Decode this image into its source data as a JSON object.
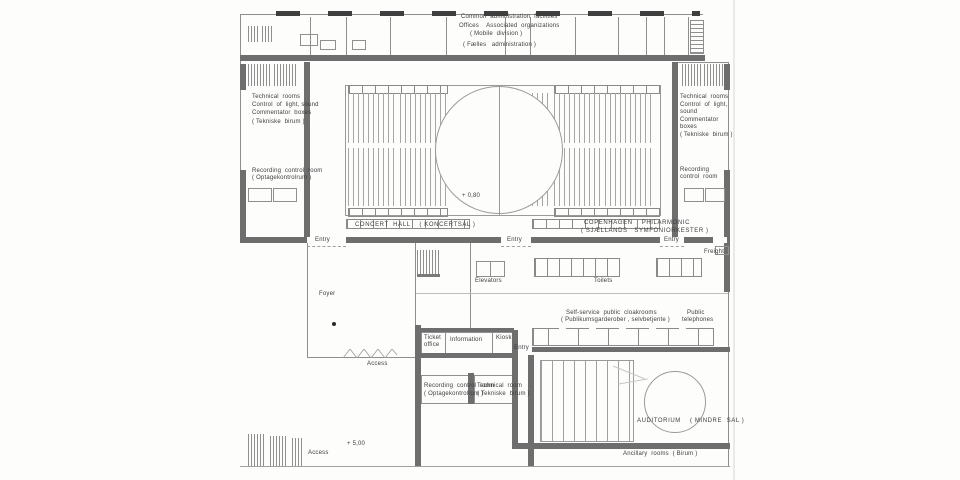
{
  "meta": {
    "drawing_type": "concert hall floor plan (scanned architectural drawing)"
  },
  "colors": {
    "paper": "#fdfdfc",
    "thin_line": "#8f8f8f",
    "thick_wall": "#6e6e6e",
    "hatch": "#a6a6a6",
    "text": "#3d3d3d",
    "window_band": "#3f3f3f"
  },
  "levels": {
    "hall_level": "+ 0,80",
    "plaza_level": "+ 5,00"
  },
  "rooms": {
    "concert_hall": "CONCERT  HALL    ( KONCERTSAL )",
    "orchestra": "COPENHAGEN    PHILARMONIC  ( SJÆLLANDS   SYMFONIORKESTER )",
    "auditorium": "AUDITORIUM    ( MINDRE  SAL )",
    "administration": "Common  administration  facilities",
    "foyer": "Foyer"
  },
  "labels": [
    {
      "id": "admin-1",
      "text": "Common  administration  facilities",
      "x": 461,
      "y": 14
    },
    {
      "id": "admin-2",
      "text": "Offices    Associated  organizations",
      "x": 459,
      "y": 23
    },
    {
      "id": "admin-3",
      "text": "( Mobile  division )",
      "x": 470,
      "y": 31
    },
    {
      "id": "admin-4",
      "text": "( Fælles   administration )",
      "x": 463,
      "y": 42
    },
    {
      "id": "left-tech-1",
      "text": "Technical  rooms",
      "x": 252,
      "y": 94
    },
    {
      "id": "left-tech-2",
      "text": "Control  of  light, sound",
      "x": 252,
      "y": 102
    },
    {
      "id": "left-tech-3",
      "text": "Commentator  boxes",
      "x": 252,
      "y": 110
    },
    {
      "id": "left-tech-4",
      "text": "( Tekniske  birum )",
      "x": 252,
      "y": 119
    },
    {
      "id": "left-rec-1",
      "text": "Recording  control  room",
      "x": 252,
      "y": 168
    },
    {
      "id": "left-rec-2",
      "text": "( Optagekontrolrum )",
      "x": 252,
      "y": 175
    },
    {
      "id": "right-tech-1",
      "text": "Technical  rooms",
      "x": 680,
      "y": 94
    },
    {
      "id": "right-tech-2",
      "text": "Control  of  light,",
      "x": 680,
      "y": 102
    },
    {
      "id": "right-tech-3",
      "text": "sound",
      "x": 680,
      "y": 109
    },
    {
      "id": "right-tech-4",
      "text": "Commentator",
      "x": 680,
      "y": 117
    },
    {
      "id": "right-tech-5",
      "text": "boxes",
      "x": 680,
      "y": 124
    },
    {
      "id": "right-tech-6",
      "text": "( Tekniske  birum )",
      "x": 680,
      "y": 132
    },
    {
      "id": "right-rec-1",
      "text": "Recording",
      "x": 680,
      "y": 167
    },
    {
      "id": "right-rec-2",
      "text": "control  room",
      "x": 680,
      "y": 174
    },
    {
      "id": "hall-level",
      "text": "+ 0,80",
      "x": 462,
      "y": 193
    },
    {
      "id": "hall-name",
      "text": "CONCERT  HALL    ( KONCERTSAL )",
      "x": 355,
      "y": 222,
      "caps": true
    },
    {
      "id": "orch-1",
      "text": "COPENHAGEN    PHILARMONIC",
      "x": 584,
      "y": 220,
      "caps": true
    },
    {
      "id": "orch-2",
      "text": "( SJÆLLANDS   SYMFONIORKESTER )",
      "x": 581,
      "y": 228,
      "caps": true
    },
    {
      "id": "entry-left",
      "text": "Entry",
      "x": 315,
      "y": 237
    },
    {
      "id": "entry-center",
      "text": "Entry",
      "x": 507,
      "y": 237
    },
    {
      "id": "entry-right",
      "text": "Entry",
      "x": 664,
      "y": 237
    },
    {
      "id": "freight",
      "text": "Freight",
      "x": 704,
      "y": 249
    },
    {
      "id": "foyer",
      "text": "Foyer",
      "x": 319,
      "y": 291
    },
    {
      "id": "elevators",
      "text": "Elevators",
      "x": 475,
      "y": 278
    },
    {
      "id": "toilets",
      "text": "Toilets",
      "x": 594,
      "y": 278
    },
    {
      "id": "cloak-1",
      "text": "Self-service  public  cloakrooms",
      "x": 566,
      "y": 310
    },
    {
      "id": "cloak-2",
      "text": "( Publikumsgarderober , selvbetjente )",
      "x": 561,
      "y": 317
    },
    {
      "id": "phones-1",
      "text": "Public",
      "x": 687,
      "y": 310
    },
    {
      "id": "phones-2",
      "text": "telephones",
      "x": 682,
      "y": 317
    },
    {
      "id": "ticket-1",
      "text": "Ticket",
      "x": 424,
      "y": 335
    },
    {
      "id": "ticket-2",
      "text": "office",
      "x": 424,
      "y": 342
    },
    {
      "id": "information",
      "text": "Information",
      "x": 450,
      "y": 337
    },
    {
      "id": "kiosk",
      "text": "Kiosk",
      "x": 496,
      "y": 335
    },
    {
      "id": "entry-ticket",
      "text": "Entry",
      "x": 514,
      "y": 345
    },
    {
      "id": "access-foyer",
      "text": "Access",
      "x": 367,
      "y": 361
    },
    {
      "id": "rec2-1",
      "text": "Recording  control  room",
      "x": 424,
      "y": 383
    },
    {
      "id": "rec2-2",
      "text": "( Optagekontrolrum )",
      "x": 424,
      "y": 391
    },
    {
      "id": "tech2-1",
      "text": "Technical  room",
      "x": 477,
      "y": 383
    },
    {
      "id": "tech2-2",
      "text": "( Tekniske  birum )",
      "x": 477,
      "y": 391
    },
    {
      "id": "auditorium",
      "text": "AUDITORIUM    ( MINDRE  SAL )",
      "x": 637,
      "y": 418,
      "caps": true
    },
    {
      "id": "plaza-level",
      "text": "+ 5,00",
      "x": 347,
      "y": 441
    },
    {
      "id": "access-plaza",
      "text": "Access",
      "x": 308,
      "y": 450
    },
    {
      "id": "ancillary",
      "text": "Ancillary  rooms  ( Birum )",
      "x": 623,
      "y": 451
    }
  ]
}
